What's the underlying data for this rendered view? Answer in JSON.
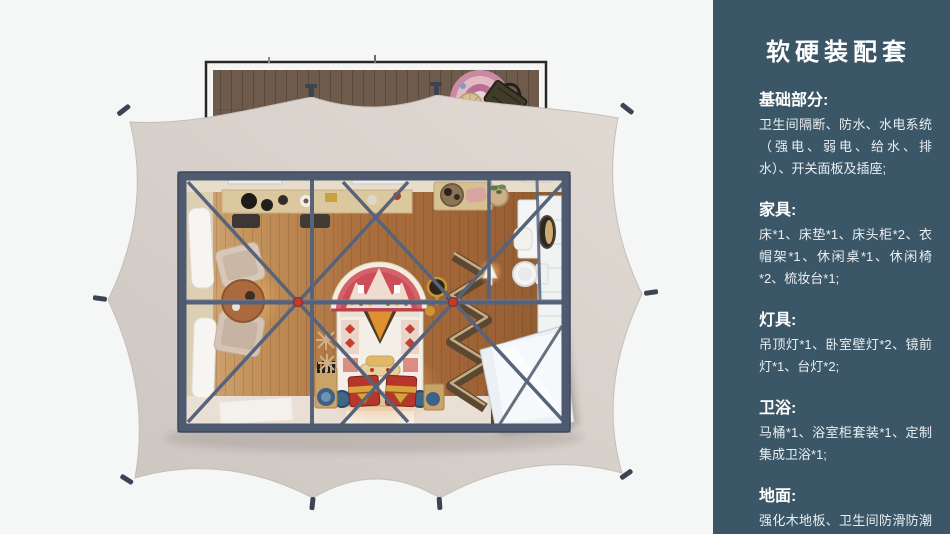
{
  "panel": {
    "title": "软硬装配套",
    "accent_color": "#3b5767",
    "text_color": "#ffffff",
    "sections": [
      {
        "heading": "基础部分:",
        "body": "卫生间隔断、防水、水电系统（强电、弱电、给水、排水）、开关面板及插座;"
      },
      {
        "heading": "家具:",
        "body": "床*1、床垫*1、床头柜*2、衣帽架*1、休闲桌*1、休闲椅*2、梳妆台*1;"
      },
      {
        "heading": "灯具:",
        "body": "吊顶灯*1、卧室壁灯*2、镜前灯*1、台灯*2;"
      },
      {
        "heading": "卫浴:",
        "body": "马桶*1、浴室柜套装*1、定制集成卫浴*1;"
      },
      {
        "heading": "地面:",
        "body": "强化木地板、卫生间防滑防潮石塑板;"
      }
    ]
  },
  "plan": {
    "type": "top-down-floor-plan-render",
    "colors": {
      "tent_canvas": "#d8d0c9",
      "steel_frame": "#4e5a6f",
      "wood_floor": "#aa6f3f",
      "deck_wood": "#6f5b4b",
      "bed_accent": "#c9404d",
      "chest_red": "#b8352b",
      "connector_red": "#c23a2e"
    },
    "features": [
      "tent-canvas",
      "wood-deck",
      "round-rug",
      "bed-with-mandala-headboard",
      "red-gold-chests",
      "lounge-chairs",
      "round-side-table",
      "dressing-table",
      "folding-screen",
      "bathroom-vanity",
      "mirror",
      "toilet",
      "shower-enclosure",
      "roof-braces"
    ]
  }
}
